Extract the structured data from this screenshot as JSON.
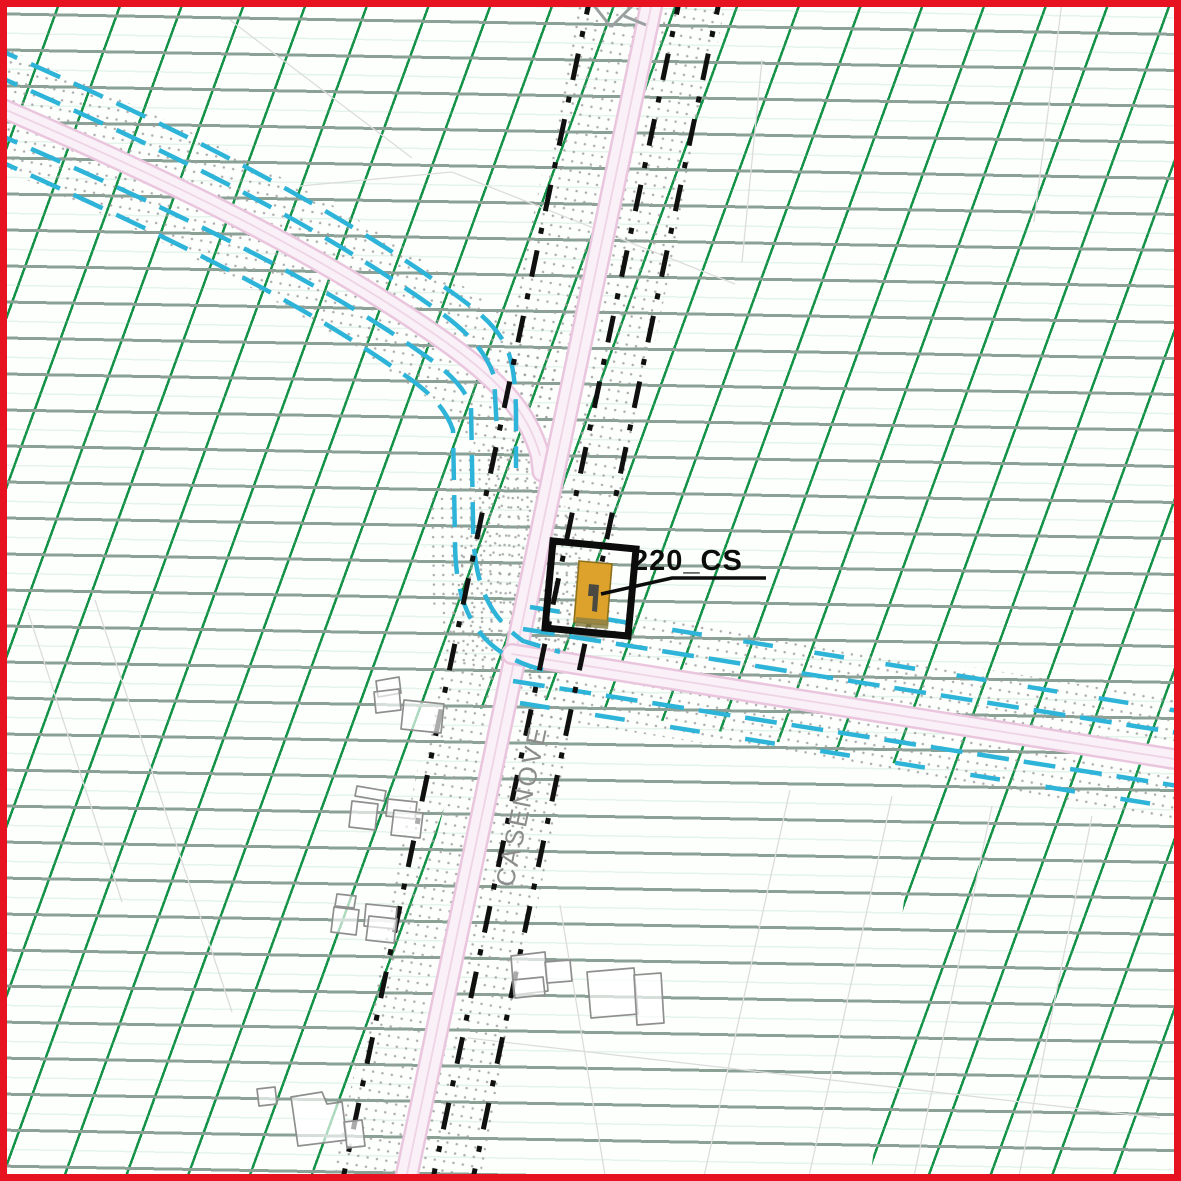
{
  "map": {
    "substation_label": "220_CS",
    "street_label": "CASENOVE",
    "colors": {
      "frame_red": "#e81321",
      "hatch_diagonal_green": "#149348",
      "hatch_horizontal_gray": "#8ba196",
      "road_pink_fill": "#faf0f7",
      "road_pink_edge": "#eac6de",
      "utility_cyan": "#2eb4d8",
      "boundary_dash_black": "#101010",
      "stipple_gray": "#9e9e9e",
      "building_outline_gray": "#8f8f8f",
      "parcel_line_gray": "#dcdcdc",
      "cabin_orange_fill": "#dda22b",
      "cabin_orange_edge": "#8d701c",
      "street_label_gray": "#8c8c8c"
    }
  }
}
